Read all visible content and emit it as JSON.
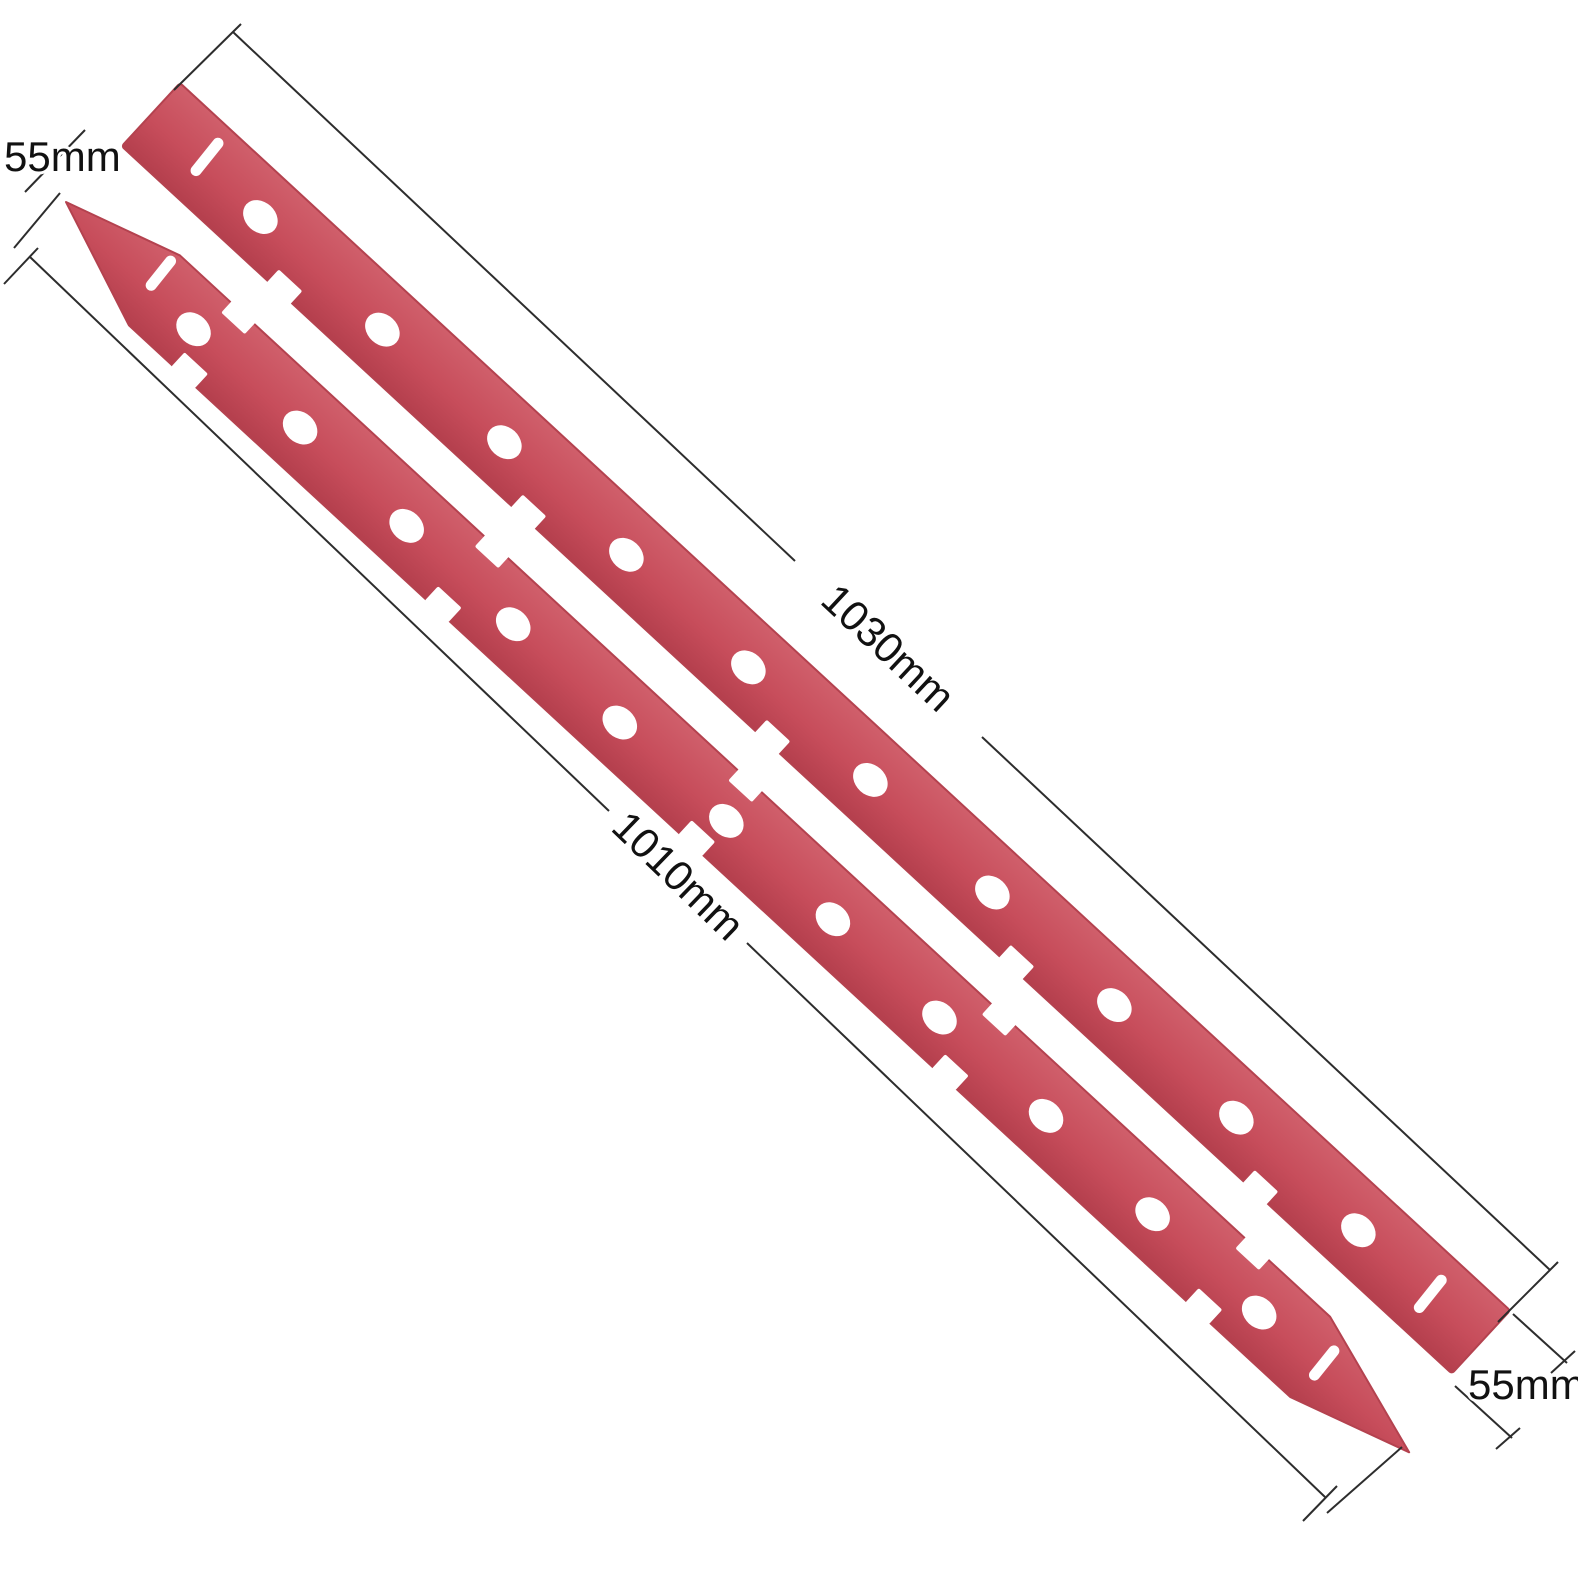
{
  "page": {
    "background": "#ffffff",
    "description": "Product image of two red squeegee rubber blades laid diagonally with dimension annotations"
  },
  "product": {
    "item": "squeegee-blade-set",
    "blade_color": "#c74d5b",
    "blade_color_light": "#d05f6b",
    "blade_color_dark": "#b43f4d",
    "blade_count": 2,
    "top_blade": {
      "holes": 10,
      "slits": 2,
      "edge_notches": 5,
      "ends": "square"
    },
    "bottom_blade": {
      "holes": 11,
      "slits": 2,
      "edge_notches": 10,
      "ends": "pointed"
    }
  },
  "annotations": {
    "line_color": "#2d2d2d",
    "text_color": "#111111",
    "labels": {
      "top_left_width": "55mm",
      "top_blade_length": "1030mm",
      "bottom_blade_length": "1010mm",
      "bottom_right_width": "55mm"
    }
  }
}
